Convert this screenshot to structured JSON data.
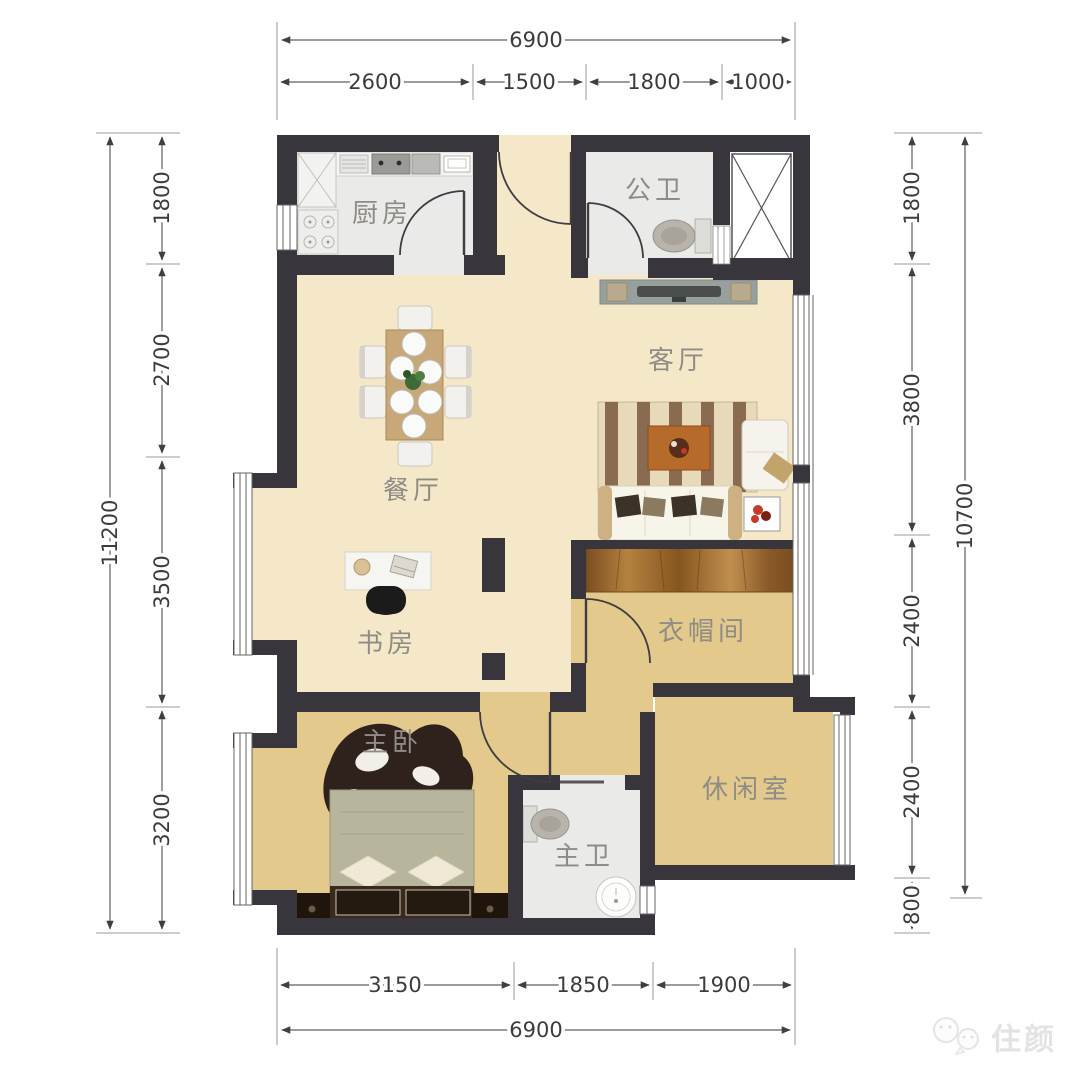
{
  "watermark": {
    "text": "住颜"
  },
  "rooms": {
    "kitchen": "厨房",
    "public_bath": "公卫",
    "living": "客厅",
    "dining": "餐厅",
    "study": "书房",
    "cloak": "衣帽间",
    "bedroom": "主卧",
    "leisure": "休闲室",
    "master_bath": "主卫"
  },
  "dims": {
    "top": {
      "total": "6900",
      "segments": [
        "2600",
        "1500",
        "1800",
        "1000"
      ]
    },
    "bottom": {
      "total": "6900",
      "segments": [
        "3150",
        "1850",
        "1900"
      ]
    },
    "left": {
      "total": "11200",
      "segments": [
        "1800",
        "2700",
        "3500",
        "3200"
      ]
    },
    "right": {
      "total": "10700",
      "segments": [
        "1800",
        "3800",
        "2400",
        "2400",
        "800"
      ]
    }
  },
  "colors": {
    "wall": "#38363c",
    "floor_cream": "#f4e8c8",
    "floor_tan": "#e3c98c",
    "floor_gray": "#eaeae8",
    "wood": "#a06a33",
    "label_text": "#8e8c85",
    "dim_text": "#3c3c3c"
  }
}
